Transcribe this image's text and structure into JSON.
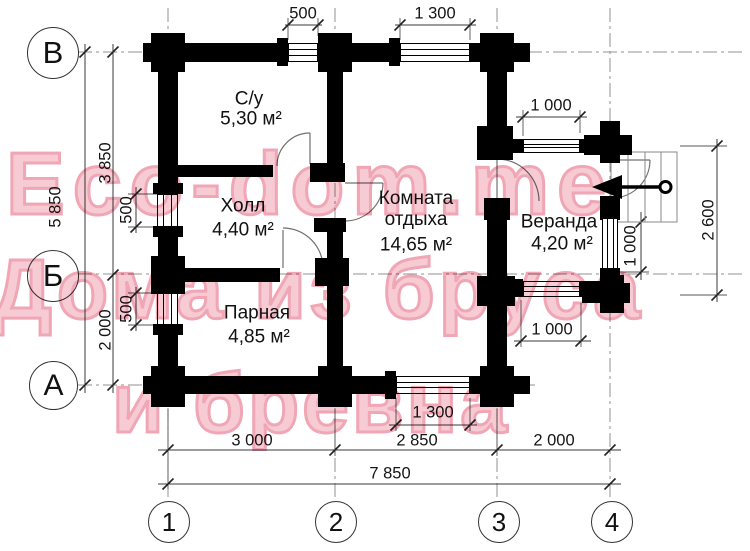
{
  "watermark": {
    "line1": "Eco-dom.me",
    "line2": "Дома из бруса",
    "line3": "и бревна",
    "fill_color": "#f6cbd4",
    "outline_color": "#f0a6b5"
  },
  "axis_markers": {
    "rows": [
      {
        "label": "В"
      },
      {
        "label": "Б"
      },
      {
        "label": "А"
      }
    ],
    "columns": [
      {
        "label": "1"
      },
      {
        "label": "2"
      },
      {
        "label": "3"
      },
      {
        "label": "4"
      }
    ]
  },
  "rooms": [
    {
      "name": "С/у",
      "area": "5,30 м²"
    },
    {
      "name": "Холл",
      "area": "4,40 м²"
    },
    {
      "name": "Комната отдыха",
      "area": "14,65 м²"
    },
    {
      "name": "Парная",
      "area": "4,85 м²"
    },
    {
      "name": "Веранда",
      "area": "4,20 м²"
    }
  ],
  "dimensions": {
    "top": [
      {
        "value": "500"
      },
      {
        "value": "1 300"
      }
    ],
    "left": [
      {
        "value": "3 850"
      },
      {
        "value": "5 850"
      },
      {
        "value": "500"
      },
      {
        "value": "2 000"
      },
      {
        "value": "500"
      }
    ],
    "right": [
      {
        "value": "1 000"
      },
      {
        "value": "2 600"
      },
      {
        "value": "1 000"
      },
      {
        "value": "1 000"
      }
    ],
    "bottom_window": {
      "value": "1 300"
    },
    "bottom": [
      {
        "value": "3 000"
      },
      {
        "value": "2 850"
      },
      {
        "value": "2 000"
      }
    ],
    "total": {
      "value": "7 850"
    }
  },
  "colors": {
    "walls": "#000000",
    "dimension_lines": "#3a3a3a",
    "grid_lines": "#909090",
    "door_arcs": "#707070"
  }
}
